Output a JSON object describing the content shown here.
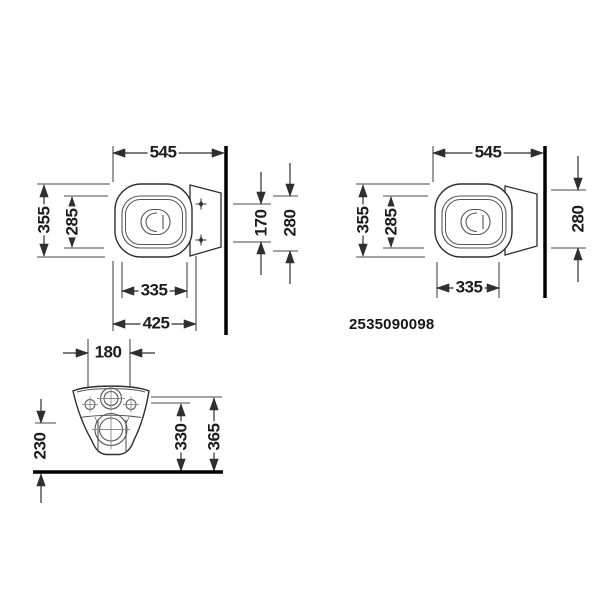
{
  "drawing": {
    "product_number": "2535090098",
    "line_color": "#2f2f2f",
    "wall_floor_color": "#000000",
    "background_color": "#ffffff",
    "views": {
      "top_left": {
        "dims": {
          "total_depth": "545",
          "outer_width": "355",
          "rim_width": "285",
          "fixing_distance": "170",
          "rear_width": "280",
          "rim_length": "335",
          "bowl_depth": "425"
        }
      },
      "top_right": {
        "dims": {
          "total_depth": "545",
          "outer_width": "355",
          "rim_width": "285",
          "rear_width": "280",
          "rim_length": "335"
        }
      },
      "front": {
        "dims": {
          "fixing_distance": "180",
          "bottom_height": "230",
          "outlet_height": "330",
          "rim_height": "365"
        }
      }
    }
  }
}
